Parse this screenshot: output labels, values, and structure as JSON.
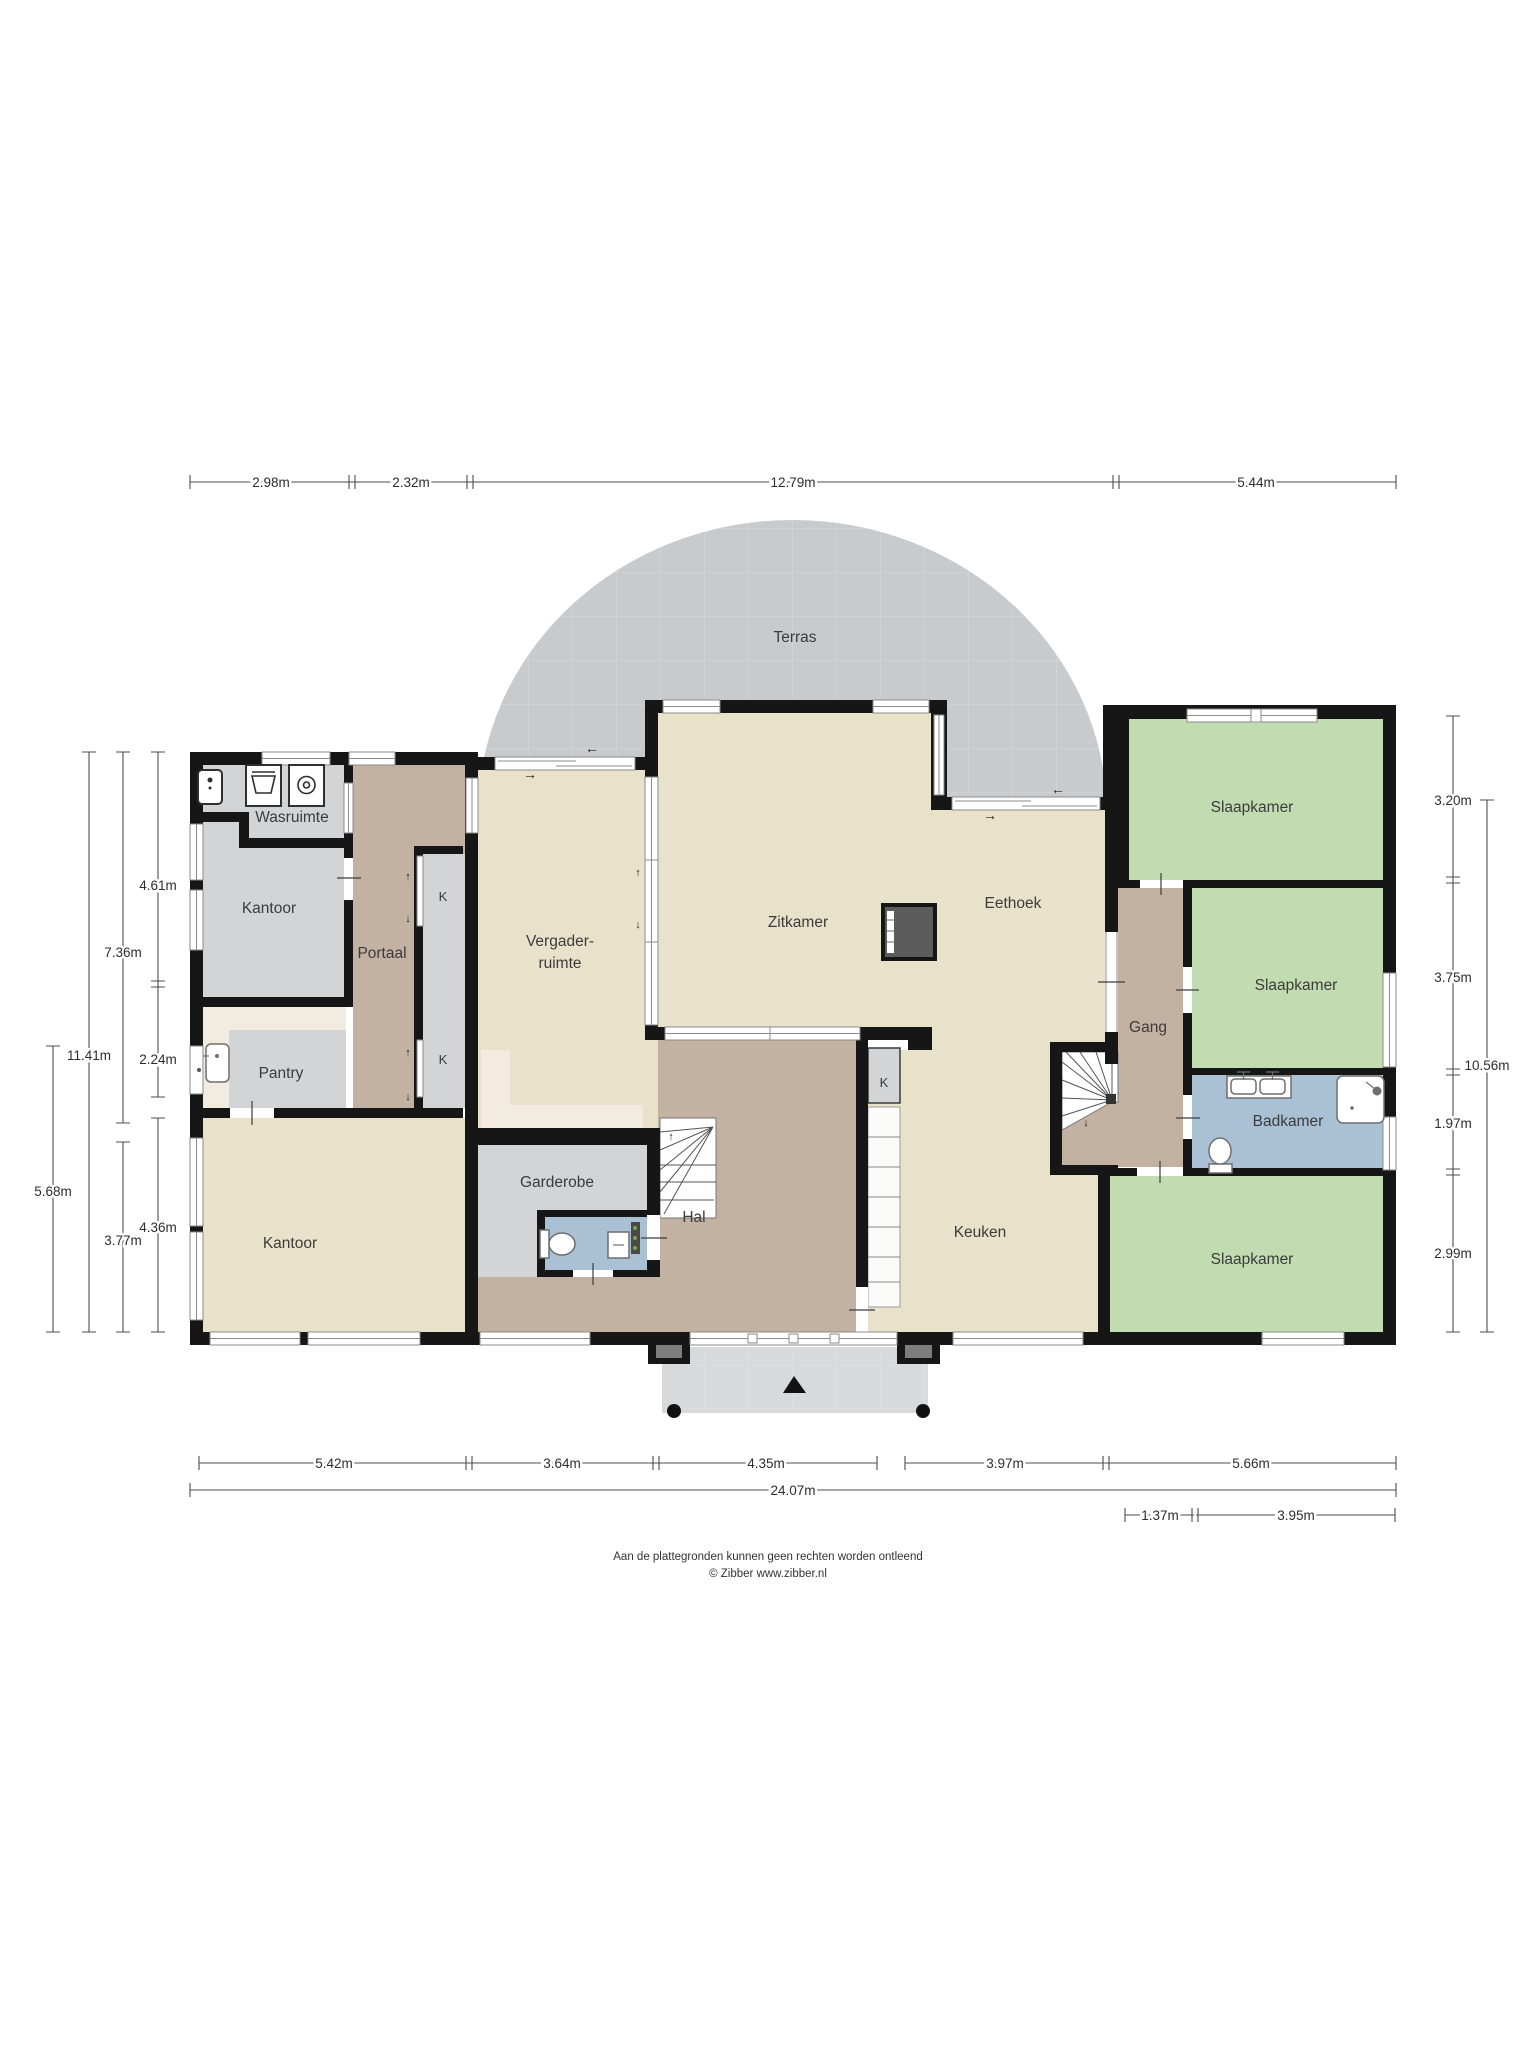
{
  "rooms": {
    "terras": "Terras",
    "wasruimte": "Wasruimte",
    "kantoor_boven": "Kantoor",
    "portaal": "Portaal",
    "kast_boven": "K",
    "kast_onder": "K",
    "pantry": "Pantry",
    "kantoor_onder": "Kantoor",
    "vergaderruimte_regel1": "Vergader-",
    "vergaderruimte_regel2": "ruimte",
    "zitkamer": "Zitkamer",
    "eethoek": "Eethoek",
    "garderobe": "Garderobe",
    "hal": "Hal",
    "kast_keuken": "K",
    "keuken": "Keuken",
    "gang": "Gang",
    "slaapkamer_1": "Slaapkamer",
    "slaapkamer_2": "Slaapkamer",
    "badkamer": "Badkamer",
    "slaapkamer_3": "Slaapkamer"
  },
  "dimensions": {
    "top": {
      "d1": "2.98m",
      "d2": "2.32m",
      "d3": "12.79m",
      "d4": "5.44m"
    },
    "left": {
      "d1": "4.61m",
      "d2": "7.36m",
      "d3": "11.41m",
      "d4": "2.24m",
      "d5": "5.68m",
      "d6": "4.36m",
      "d7": "3.77m"
    },
    "right": {
      "d1": "3.20m",
      "d2": "3.75m",
      "d3": "10.56m",
      "d4": "1.97m",
      "d5": "2.99m"
    },
    "bottom": {
      "d1": "5.42m",
      "d2": "3.64m",
      "d3": "4.35m",
      "d4": "3.97m",
      "d5": "5.66m",
      "total": "24.07m",
      "d6": "1.37m",
      "d7": "3.95m"
    }
  },
  "icons": {
    "arrow_left": "←",
    "arrow_right": "→",
    "arrow_up": "↑",
    "arrow_down": "↓"
  },
  "footer": {
    "line1": "Aan de plattegronden kunnen geen rechten worden ontleend",
    "line2": "© Zibber www.zibber.nl"
  },
  "colors": {
    "wall": "#161616",
    "living_beige": "#e9e2cb",
    "hallway_brown": "#c3b2a2",
    "utility_gray": "#d2d4d5",
    "bedroom_green": "#c2dcb1",
    "bathroom_blue": "#a9c0d5",
    "counter_cream": "#f1ecdf",
    "terrace_gray": "#c8cbce",
    "porch_gray": "#d7d9da"
  }
}
